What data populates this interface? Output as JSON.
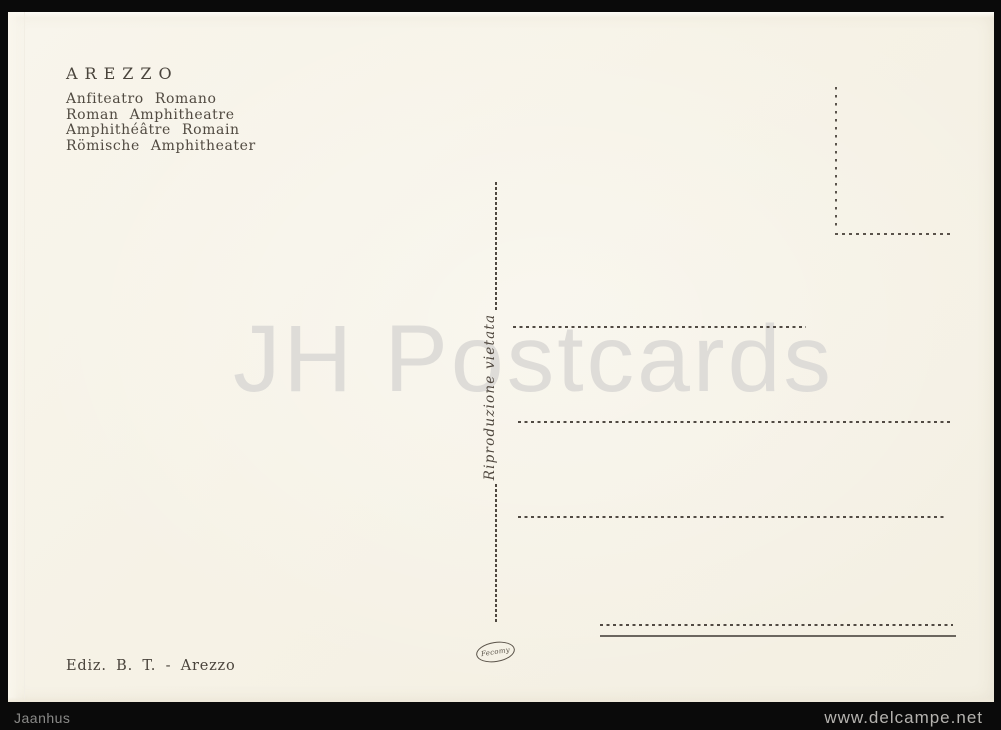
{
  "scene": {
    "background_color": "#0a0a0a"
  },
  "postcard": {
    "paper_color": "#f6f2e7",
    "ink_color": "#4a443c",
    "header": {
      "title": "AREZZO",
      "subtitles": [
        "Anfiteatro Romano",
        "Roman Amphitheatre",
        "Amphithéâtre Romain",
        "Römische Amphitheater"
      ]
    },
    "center_divider": {
      "notice": "Riproduzione vietata"
    },
    "watermark": {
      "text": "JH Postcards",
      "color": "#dedcd8"
    },
    "publisher": "Ediz. B. T. - Arezzo",
    "printer_mark": "Fecomy"
  },
  "footer": {
    "seller": "Jaanhus",
    "website": "www.delcampe.net"
  }
}
